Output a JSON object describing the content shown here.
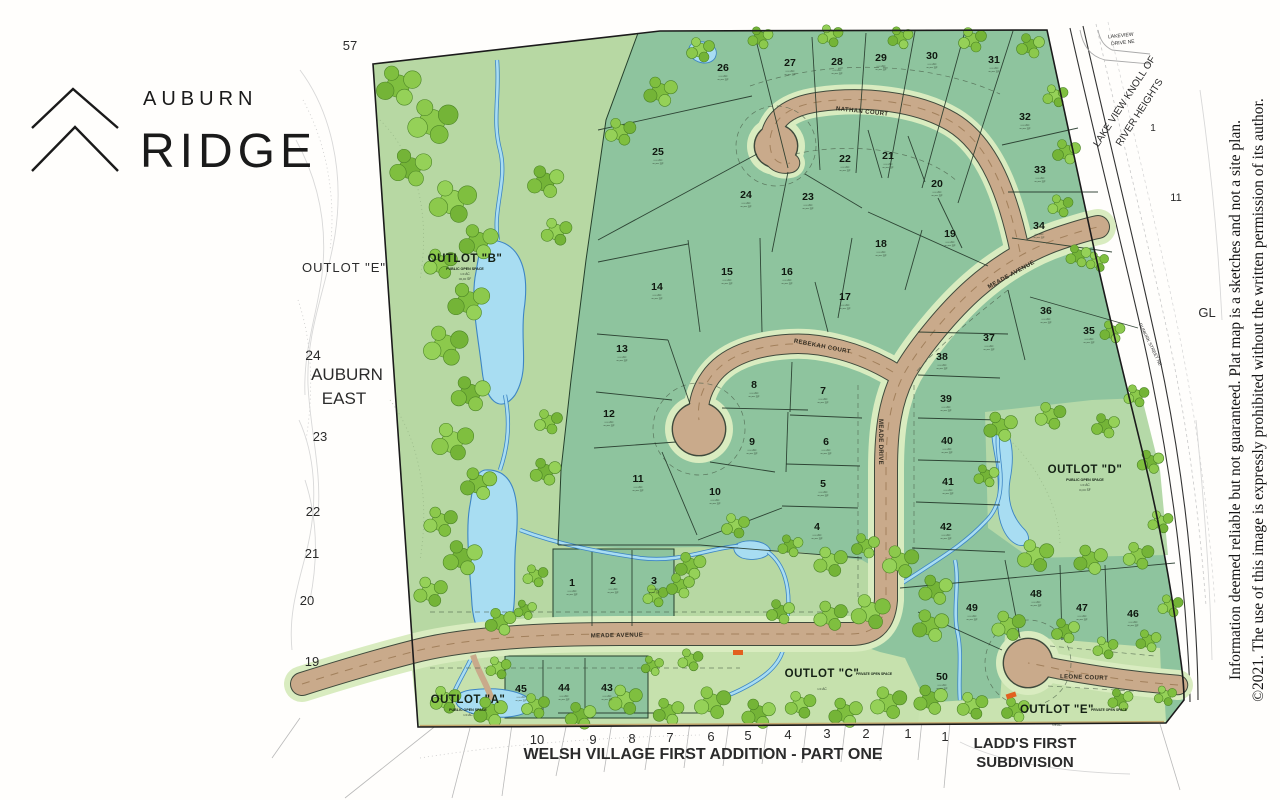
{
  "logo": {
    "line1": "AUBURN",
    "line2": "RIDGE"
  },
  "disclaimer": {
    "line1": "Information deemed reliable but not guaranteed. Plat map is a sketches and not a site plan.",
    "line2": "©2021.  The use of  this image is expressly prohibited without the written permission of its author."
  },
  "colors": {
    "lot_green": "#8ec49e",
    "open_green": "#bbdaa7",
    "road_tan": "#c9aa8b",
    "water_blue": "#a8ddf2",
    "tree_green": "#7fbf3f"
  },
  "map": {
    "lot_area_hint": [
      "•.•• AC",
      "••,••• SF"
    ],
    "streets": [
      {
        "name": "NATHAN COURT",
        "x": 862,
        "y": 113,
        "rot": 6
      },
      {
        "name": "MEADE AVENUE",
        "x": 1012,
        "y": 276,
        "rot": -29
      },
      {
        "name": "REBEKAH COURT",
        "x": 822,
        "y": 348,
        "rot": 11
      },
      {
        "name": "MEADE DRIVE",
        "x": 879,
        "y": 442,
        "rot": 90
      },
      {
        "name": "MEADE AVENUE",
        "x": 617,
        "y": 637,
        "rot": -1
      },
      {
        "name": "LEONE COURT",
        "x": 1084,
        "y": 679,
        "rot": 2
      }
    ],
    "lots": [
      {
        "n": "1",
        "x": 572,
        "y": 583
      },
      {
        "n": "2",
        "x": 613,
        "y": 581
      },
      {
        "n": "3",
        "x": 654,
        "y": 581
      },
      {
        "n": "4",
        "x": 817,
        "y": 527
      },
      {
        "n": "5",
        "x": 823,
        "y": 484
      },
      {
        "n": "6",
        "x": 826,
        "y": 442
      },
      {
        "n": "7",
        "x": 823,
        "y": 391
      },
      {
        "n": "8",
        "x": 754,
        "y": 385
      },
      {
        "n": "9",
        "x": 752,
        "y": 442
      },
      {
        "n": "10",
        "x": 715,
        "y": 492
      },
      {
        "n": "11",
        "x": 638,
        "y": 479
      },
      {
        "n": "12",
        "x": 609,
        "y": 414
      },
      {
        "n": "13",
        "x": 622,
        "y": 349
      },
      {
        "n": "14",
        "x": 657,
        "y": 287
      },
      {
        "n": "15",
        "x": 727,
        "y": 272
      },
      {
        "n": "16",
        "x": 787,
        "y": 272
      },
      {
        "n": "17",
        "x": 845,
        "y": 297
      },
      {
        "n": "18",
        "x": 881,
        "y": 244
      },
      {
        "n": "19",
        "x": 950,
        "y": 234
      },
      {
        "n": "20",
        "x": 937,
        "y": 184
      },
      {
        "n": "21",
        "x": 888,
        "y": 156
      },
      {
        "n": "22",
        "x": 845,
        "y": 159
      },
      {
        "n": "23",
        "x": 808,
        "y": 197
      },
      {
        "n": "24",
        "x": 746,
        "y": 195
      },
      {
        "n": "25",
        "x": 658,
        "y": 152
      },
      {
        "n": "26",
        "x": 723,
        "y": 68
      },
      {
        "n": "27",
        "x": 790,
        "y": 63
      },
      {
        "n": "28",
        "x": 837,
        "y": 62
      },
      {
        "n": "29",
        "x": 881,
        "y": 58
      },
      {
        "n": "30",
        "x": 932,
        "y": 56
      },
      {
        "n": "31",
        "x": 994,
        "y": 60
      },
      {
        "n": "32",
        "x": 1025,
        "y": 117
      },
      {
        "n": "33",
        "x": 1040,
        "y": 170
      },
      {
        "n": "34",
        "x": 1039,
        "y": 226
      },
      {
        "n": "35",
        "x": 1089,
        "y": 331
      },
      {
        "n": "36",
        "x": 1046,
        "y": 311
      },
      {
        "n": "37",
        "x": 989,
        "y": 338
      },
      {
        "n": "38",
        "x": 942,
        "y": 357
      },
      {
        "n": "39",
        "x": 946,
        "y": 399
      },
      {
        "n": "40",
        "x": 947,
        "y": 441
      },
      {
        "n": "41",
        "x": 948,
        "y": 482
      },
      {
        "n": "42",
        "x": 946,
        "y": 527
      },
      {
        "n": "43",
        "x": 607,
        "y": 688
      },
      {
        "n": "44",
        "x": 564,
        "y": 688
      },
      {
        "n": "45",
        "x": 521,
        "y": 689
      },
      {
        "n": "46",
        "x": 1133,
        "y": 614
      },
      {
        "n": "47",
        "x": 1082,
        "y": 608
      },
      {
        "n": "48",
        "x": 1036,
        "y": 594
      },
      {
        "n": "49",
        "x": 972,
        "y": 608
      },
      {
        "n": "50",
        "x": 942,
        "y": 677
      }
    ],
    "outlots": [
      {
        "label": "OUTLOT \"B\"",
        "note": "PUBLIC OPEN SPACE",
        "x": 465,
        "y": 262,
        "np": "b",
        "extra": [
          "•.•• AC",
          "•••,••• SF"
        ]
      },
      {
        "label": "OUTLOT \"D\"",
        "note": "PUBLIC OPEN SPACE",
        "x": 1085,
        "y": 473,
        "np": "b",
        "extra": [
          "•.•• AC",
          "••,••• SF"
        ]
      },
      {
        "label": "OUTLOT \"A\"",
        "note": "PUBLIC OPEN SPACE",
        "x": 468,
        "y": 703,
        "np": "b",
        "extra": [
          "•.•• AC"
        ]
      },
      {
        "label": "OUTLOT \"C\"",
        "note": "PRIVATE OPEN SPACE",
        "x": 822,
        "y": 677,
        "np": "r",
        "extra": [
          "•.•• AC"
        ]
      },
      {
        "label": "OUTLOT \"E\"",
        "note": "PRIVATE OPEN SPACE",
        "x": 1057,
        "y": 713,
        "np": "r",
        "extra": [
          "•.•• AC"
        ]
      }
    ],
    "adjacent": [
      {
        "t": "57",
        "x": 350,
        "y": 50,
        "s": 13
      },
      {
        "t": "OUTLOT \"E\"",
        "x": 344,
        "y": 272,
        "s": 13,
        "ls": 1
      },
      {
        "t": "24",
        "x": 313,
        "y": 360,
        "s": 14
      },
      {
        "t": "AUBURN",
        "x": 347,
        "y": 380,
        "s": 17,
        "w": 500
      },
      {
        "t": "EAST",
        "x": 344,
        "y": 404,
        "s": 17,
        "w": 500
      },
      {
        "t": "23",
        "x": 320,
        "y": 441,
        "s": 13
      },
      {
        "t": "22",
        "x": 313,
        "y": 516,
        "s": 13
      },
      {
        "t": "21",
        "x": 312,
        "y": 558,
        "s": 13
      },
      {
        "t": "20",
        "x": 307,
        "y": 605,
        "s": 13
      },
      {
        "t": "19",
        "x": 312,
        "y": 666,
        "s": 13
      },
      {
        "t": "10",
        "x": 537,
        "y": 744,
        "s": 13
      },
      {
        "t": "9",
        "x": 593,
        "y": 744,
        "s": 13
      },
      {
        "t": "8",
        "x": 632,
        "y": 743,
        "s": 13
      },
      {
        "t": "7",
        "x": 670,
        "y": 742,
        "s": 13
      },
      {
        "t": "6",
        "x": 711,
        "y": 741,
        "s": 13
      },
      {
        "t": "5",
        "x": 748,
        "y": 740,
        "s": 13
      },
      {
        "t": "4",
        "x": 788,
        "y": 739,
        "s": 13
      },
      {
        "t": "3",
        "x": 827,
        "y": 738,
        "s": 13
      },
      {
        "t": "2",
        "x": 866,
        "y": 738,
        "s": 13
      },
      {
        "t": "1",
        "x": 908,
        "y": 738,
        "s": 13
      },
      {
        "t": "WELSH VILLAGE FIRST ADDITION - PART ONE",
        "x": 703,
        "y": 759,
        "s": 16,
        "w": 600
      },
      {
        "t": "1",
        "x": 945,
        "y": 741,
        "s": 13
      },
      {
        "t": "LADD'S FIRST",
        "x": 1025,
        "y": 748,
        "s": 15,
        "w": 600
      },
      {
        "t": "SUBDIVISION",
        "x": 1025,
        "y": 767,
        "s": 15,
        "w": 600
      },
      {
        "t": "LAKEVIEW",
        "x": 1121,
        "y": 37,
        "s": 5,
        "rot": -6
      },
      {
        "t": "DRIVE NE",
        "x": 1123,
        "y": 44,
        "s": 5,
        "rot": -6
      },
      {
        "t": "LAKE VIEW KNOLL OF",
        "x": 1127,
        "y": 103,
        "s": 10,
        "rot": -57
      },
      {
        "t": "RIVER HEIGHTS",
        "x": 1142,
        "y": 114,
        "s": 10,
        "rot": -57
      },
      {
        "t": "1",
        "x": 1153,
        "y": 131,
        "s": 10
      },
      {
        "t": "11",
        "x": 1176,
        "y": 201,
        "s": 11
      },
      {
        "t": "GL",
        "x": 1207,
        "y": 317,
        "s": 13
      },
      {
        "t": "DUNKIRK STREET NE",
        "x": 1149,
        "y": 345,
        "s": 4.5,
        "rot": 64
      }
    ]
  }
}
